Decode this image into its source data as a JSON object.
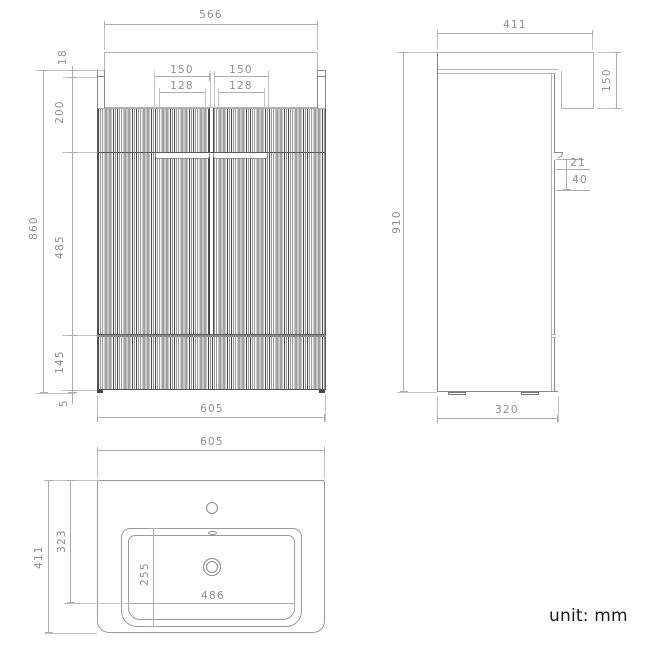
{
  "note": {
    "unit_label": "unit: mm"
  },
  "front_view": {
    "width_top": "566",
    "height_total": "860",
    "seg_top": "18",
    "seg_upper": "200",
    "seg_middle": "485",
    "seg_lower": "145",
    "seg_plinth": "5",
    "handle_span_left": "150",
    "handle_span_right": "150",
    "handle_inner_left": "128",
    "handle_inner_right": "128",
    "width_bottom": "605"
  },
  "side_view": {
    "depth_top": "411",
    "basin_front_height": "150",
    "height_total": "910",
    "handle_lip": "21",
    "handle_recess": "40",
    "depth_bottom": "320"
  },
  "top_view": {
    "width_top": "605",
    "depth_total": "411",
    "depth_to_basin_front": "323",
    "basin_depth": "255",
    "basin_width": "486"
  },
  "colors": {
    "outline": "#8a8a8a",
    "outline_light": "#b5b5b5",
    "dim": "#adadad",
    "dim_text": "#8e8e8e",
    "ext": "#c4c4c4",
    "flute_dark": "#4c4c4c",
    "note": "#1c1c1c"
  }
}
